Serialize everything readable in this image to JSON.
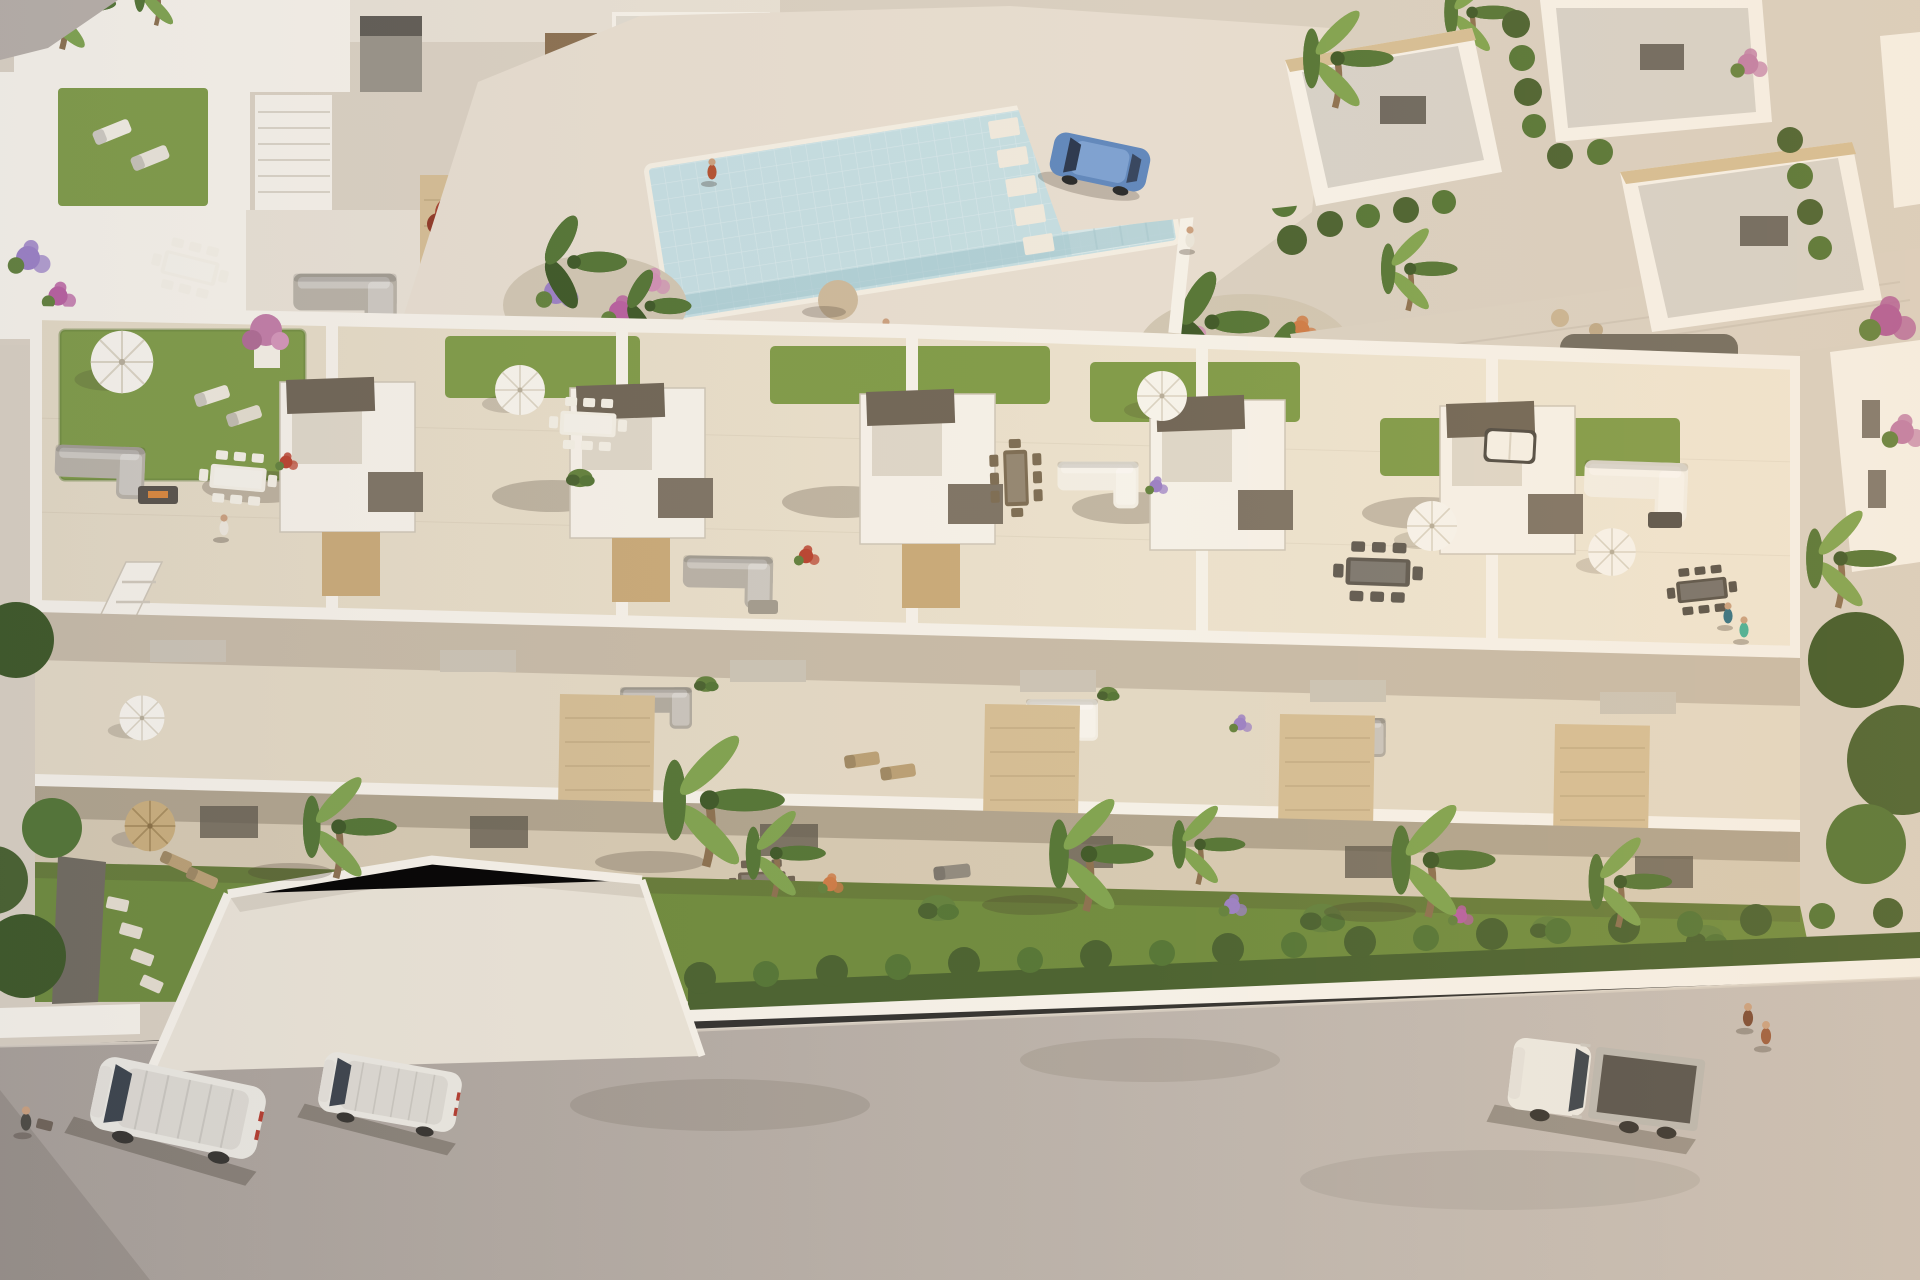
{
  "scene": {
    "title": "Aerial 3D render of a modern white residential complex with communal pool, rooftop terraces and street",
    "description": "Bird's-eye architectural visualization: a long row of white flat-roofed townhouses with rooftop terraces (artificial lawn, white parasols, lounge and dining furniture, stair bulkheads), first-floor balconies with travertine privacy screens, ground-floor terraces and gardens with palm trees, a clipped hedgerow over a white boundary wall, and a grey asphalt street with parked vehicles. Behind the row: a communal swimming pool plaza with flower beds and banana palms, an upper row of similar townhouses at top left, and a cluster of white villas with grey flat roofs at top right. Late afternoon sun from the upper right casts long soft shadows to the lower left.",
    "environment": {
      "time_of_day": "late afternoon",
      "lighting": "warm low sun from upper right, long shadows to lower left",
      "setting": "Mediterranean-style new-build residential development"
    },
    "pool": {
      "label": "communal swimming pool",
      "water_color_hex": "#c3dde2",
      "features": [
        "mosaic tile water",
        "white coping",
        "stepping-stone pads",
        "entry steps shelf",
        "flower-bed islands with banana palms"
      ]
    },
    "main_building": {
      "label": "row of six white townhouse units",
      "roof_features": [
        "artificial lawn patches",
        "white parasols",
        "grey and white lounge sofas",
        "wood and white dining sets",
        "stair bulkheads with taupe pergola slabs",
        "white daybed",
        "potted pink tree"
      ],
      "facade_features": [
        "first-floor balconies",
        "travertine privacy screens",
        "curtained glass doors",
        "ground-floor shaded terraces with dining sets"
      ]
    },
    "vehicles": [
      {
        "type": "panel van",
        "color": "white",
        "location": "street, bottom left"
      },
      {
        "type": "compact van",
        "color": "white",
        "location": "street, bottom left"
      },
      {
        "type": "flatbed truck",
        "color": "white cab, dark grey bed",
        "location": "street, bottom right"
      },
      {
        "type": "hatchback",
        "color": "blue",
        "location": "villa driveway, top centre-right"
      },
      {
        "type": "car, partially hidden by wall",
        "color": "grey",
        "location": "lane right of main building"
      }
    ],
    "people": [
      {
        "pose": "walking",
        "location": "pool deck"
      },
      {
        "pose": "walking",
        "location": "pool walkway"
      },
      {
        "pose": "standing at pool edge",
        "location": "pool"
      },
      {
        "pose": "walking",
        "location": "garden path"
      },
      {
        "pose": "exercising",
        "location": "left rooftop terrace"
      },
      {
        "pose": "standing couple",
        "location": "right rooftop terrace"
      },
      {
        "pose": "walking",
        "location": "street bottom left"
      },
      {
        "pose": "walking pair",
        "location": "street bottom right"
      }
    ],
    "vegetation": [
      "fan palms",
      "banana palms",
      "clipped hedgerow",
      "box bushes",
      "purple and magenta flower beds",
      "pink bougainvillea",
      "lawn gardens"
    ]
  },
  "palette": {
    "ground": "#d8cfc1",
    "paving_light": "#e6ddd0",
    "paving_mid": "#d9d0c2",
    "road": "#b6aea7",
    "road_light": "#c6beb6",
    "road_dark": "#a49c94",
    "sidewalk": "#cfc7bb",
    "wall_white": "#f5f1e9",
    "wall_shade": "#e7e0d4",
    "wall_dark": "#cdc5b6",
    "roof_grey": "#d5d1c9",
    "rooftile": "#e8dfcc",
    "balcony": "#e2d8c4",
    "terrace": "#d5c9b2",
    "lawn": "#7e9a47",
    "lawn_dark": "#64803a",
    "grass": "#6d8a3c",
    "grass_dark": "#54702e",
    "hedge": "#47602e",
    "hedge_light": "#61803c",
    "palm": "#527434",
    "palm_light": "#7ea24e",
    "palm_dark": "#3c5726",
    "trunk": "#8a6f4e",
    "stone": "#d4bd94",
    "stone_dark": "#b29c74",
    "wood": "#8a7456",
    "furn_dark": "#565148",
    "furn_grey": "#b4aea3",
    "furn_white": "#f3efe5",
    "taupe": "#6e6455",
    "pool": "#c3dde2",
    "pool_deep": "#9dc2cc",
    "pool_light": "#d8e8ea",
    "pool_edge": "#efe9dd",
    "car_blue": "#5d86bd",
    "veh_white": "#eae8e1",
    "veh_grey": "#8f8c85",
    "truck_bed": "#55524c",
    "skin": "#c99f7e",
    "gravel": "#6f6a5e",
    "shadow": "rgba(62,52,40,0.25)"
  }
}
